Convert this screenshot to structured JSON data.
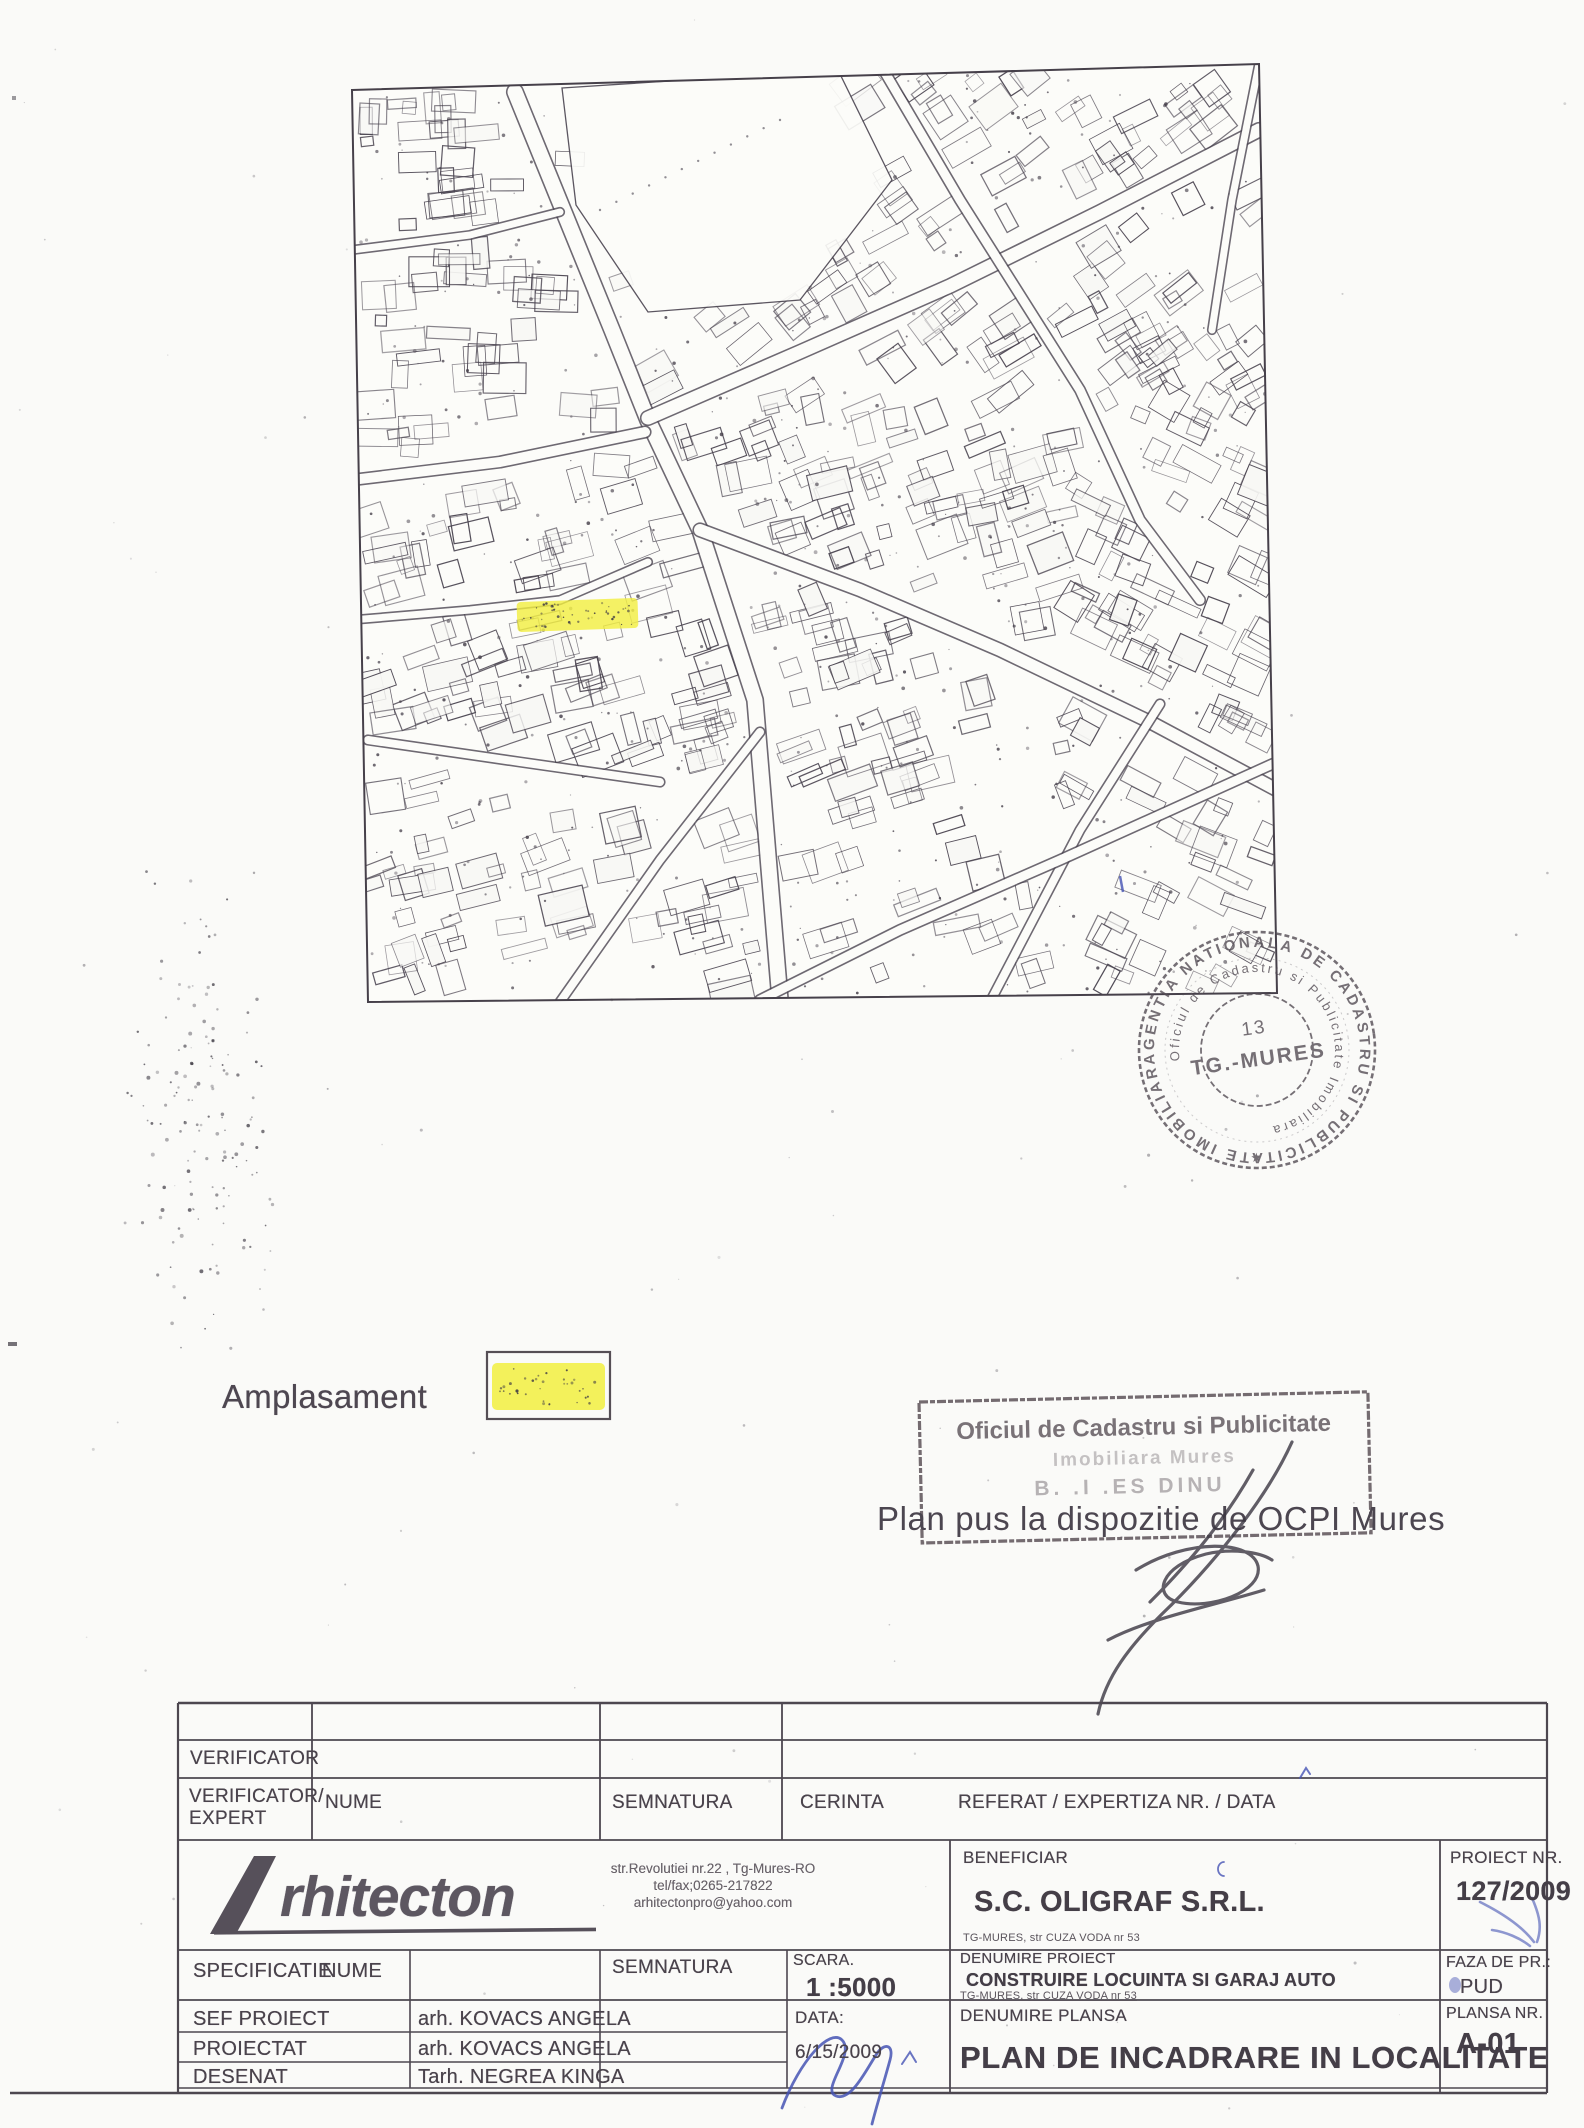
{
  "colors": {
    "highlight": "#f1ee3f",
    "blue_ink": "#4553b4",
    "stamp_gray": "#544d55",
    "line_ink": "#4d4750"
  },
  "map": {
    "legend_label": "Amplasament"
  },
  "stamps": {
    "round": {
      "outer": "AGENTIA NATIONALA DE CADASTRU SI PUBLICITATE IMOBILIARA",
      "inner": "Oficiul de Cadastru si Publicitate Imobiliara",
      "number": "13",
      "city": "TG.-MURES",
      "star": "★"
    },
    "rect": {
      "line1": "Oficiul de Cadastru si Publicitate",
      "line2": "Imobiliara Mures",
      "line3": "B. .I .ES  DINU"
    },
    "note": "Plan pus la dispozitie de OCPI Mures"
  },
  "titleblock": {
    "verificator": "VERIFICATOR",
    "verificator_expert_1": "VERIFICATOR/",
    "verificator_expert_2": "EXPERT",
    "nume": "NUME",
    "semnatura": "SEMNATURA",
    "cerinta": "CERINTA",
    "referat": "REFERAT / EXPERTIZA NR. / DATA",
    "logo_word": "rhitecton",
    "addr1": "str.Revolutiei nr.22 , Tg-Mures-RO",
    "addr2": "tel/fax;0265-217822",
    "addr3": "arhitectonpro@yahoo.com",
    "beneficiar_label": "BENEFICIAR",
    "beneficiar_name": "S.C. OLIGRAF S.R.L.",
    "beneficiar_addr": "TG-MURES, str CUZA VODA nr 53",
    "proiect_nr_label": "PROIECT NR.",
    "proiect_nr": "127/2009",
    "specificatie": "SPECIFICATIE",
    "nume2": "NUME",
    "semnatura2": "SEMNATURA",
    "scara_label": "SCARA.",
    "scara": "1 :5000",
    "denumire_proiect_label": "DENUMIRE PROIECT",
    "denumire_proiect": "CONSTRUIRE LOCUINTA SI GARAJ AUTO",
    "denumire_proiect_addr": "TG-MURES, str CUZA VODA nr 53",
    "faza_label": "FAZA DE PR.:",
    "faza": "PUD",
    "rows": [
      {
        "label": "SEF PROIECT",
        "name": "arh. KOVACS ANGELA"
      },
      {
        "label": "PROIECTAT",
        "name": "arh. KOVACS ANGELA"
      },
      {
        "label": "DESENAT",
        "name": "Tarh. NEGREA KINGA"
      }
    ],
    "data_label": "DATA:",
    "data_value": "6/15/2009",
    "denumire_plansa_label": "DENUMIRE PLANSA",
    "plansa_title": "PLAN DE INCADRARE IN LOCALITATE",
    "plansa_nr_label": "PLANSA NR.",
    "plansa_nr": "A-01"
  }
}
